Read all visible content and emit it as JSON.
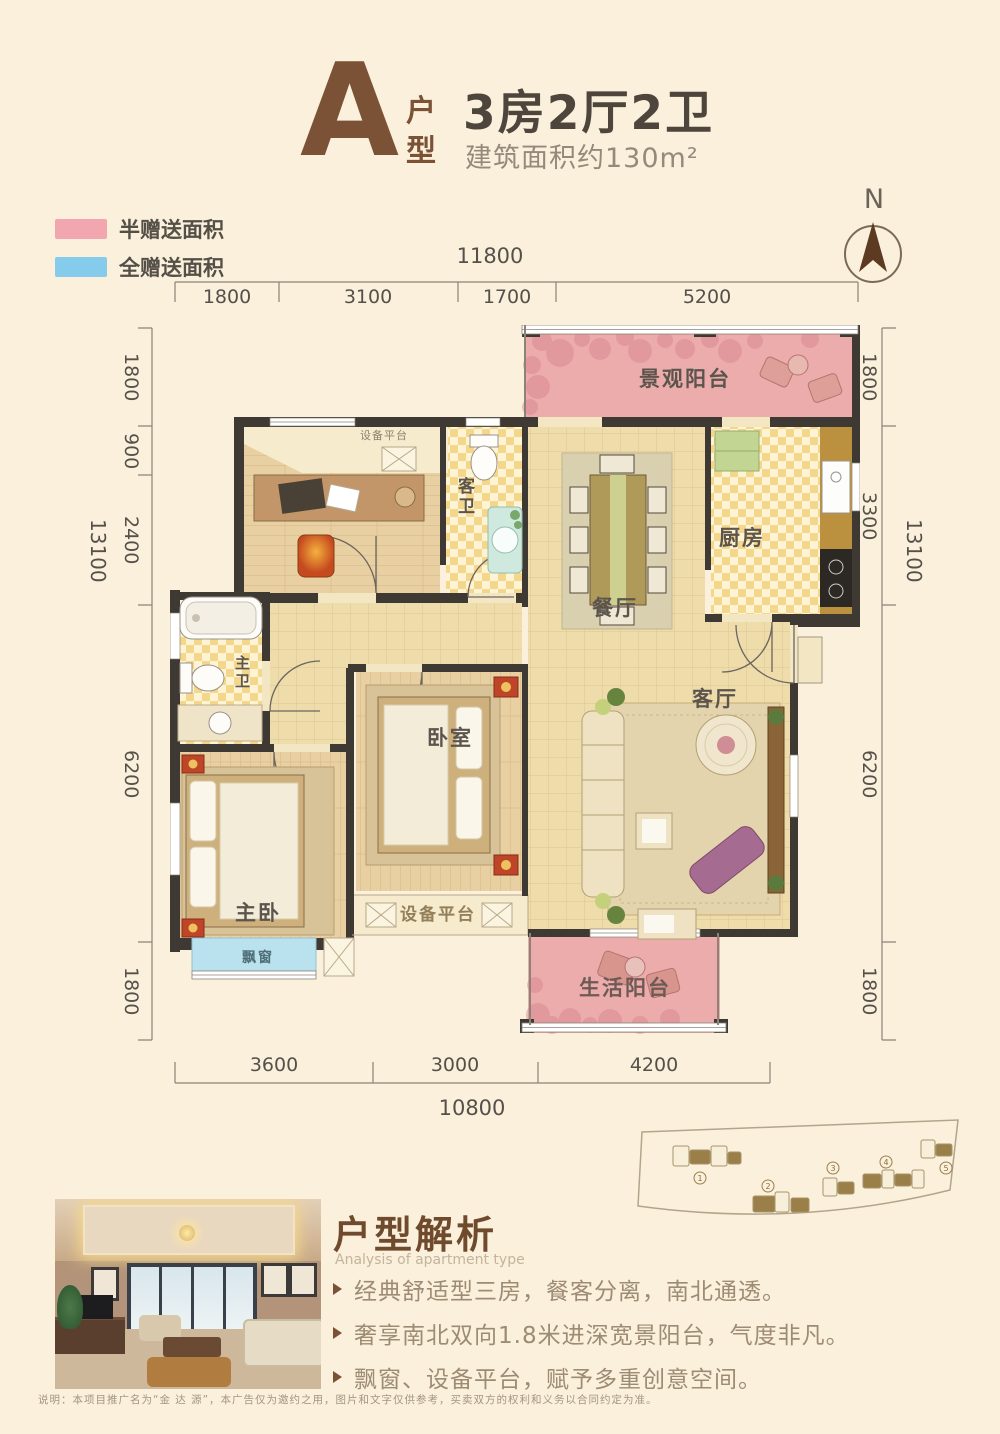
{
  "header": {
    "type_letter": "A",
    "type_label": "户型",
    "title": "3房2厅2卫",
    "subtitle": "建筑面积约130m²"
  },
  "legend": {
    "items": [
      {
        "label": "半赠送面积",
        "color": "#f2a6b0"
      },
      {
        "label": "全赠送面积",
        "color": "#85cbeb"
      }
    ]
  },
  "compass": {
    "label": "N"
  },
  "dims": {
    "top": {
      "total": "11800",
      "segments": [
        "1800",
        "3100",
        "1700",
        "5200"
      ]
    },
    "bottom": {
      "total": "10800",
      "segments": [
        "3600",
        "3000",
        "4200"
      ]
    },
    "left": {
      "total": "13100",
      "segments": [
        "1800",
        "900",
        "2400",
        "6200",
        "1800"
      ]
    },
    "right": {
      "total": "13100",
      "segments": [
        "1800",
        "3300",
        "6200",
        "1800"
      ]
    }
  },
  "rooms": {
    "view_balcony": "景观阳台",
    "equip_top": "设备平台",
    "guest_bath": "客卫",
    "dining": "餐厅",
    "kitchen": "厨房",
    "master_bath": "主卫",
    "bedroom": "卧室",
    "living": "客厅",
    "master_bedroom": "主卧",
    "bay_window": "飘窗",
    "equip_bottom": "设备平台",
    "life_balcony": "生活阳台"
  },
  "analysis": {
    "heading": "户型解析",
    "subheading": "Analysis of apartment type",
    "bullets": [
      "经典舒适型三房，餐客分离，南北通透。",
      "奢享南北双向1.8米进深宽景阳台，气度非凡。",
      "飘窗、设备平台，赋予多重创意空间。"
    ]
  },
  "siteplan": {
    "building_numbers": [
      "1",
      "2",
      "3",
      "4",
      "5"
    ]
  },
  "disclaimer": "说明：本项目推广名为“金 达 源”，本广告仅为邀约之用，图片和文字仅供参考，买卖双方的权利和义务以合同约定为准。",
  "colors": {
    "background": "#faf0dc",
    "title_brown": "#7b5236",
    "heading_brown": "#6f4a2d",
    "legend_pink": "#f2a6b0",
    "legend_blue": "#85cbeb",
    "balcony_pink": "#ecacab",
    "bay_window_blue": "#b9e2ee",
    "wall_dark": "#3e3933",
    "tile_floor": "#eedcab",
    "wood_floor": "#e8d0a2",
    "dim_text": "#55504a"
  }
}
